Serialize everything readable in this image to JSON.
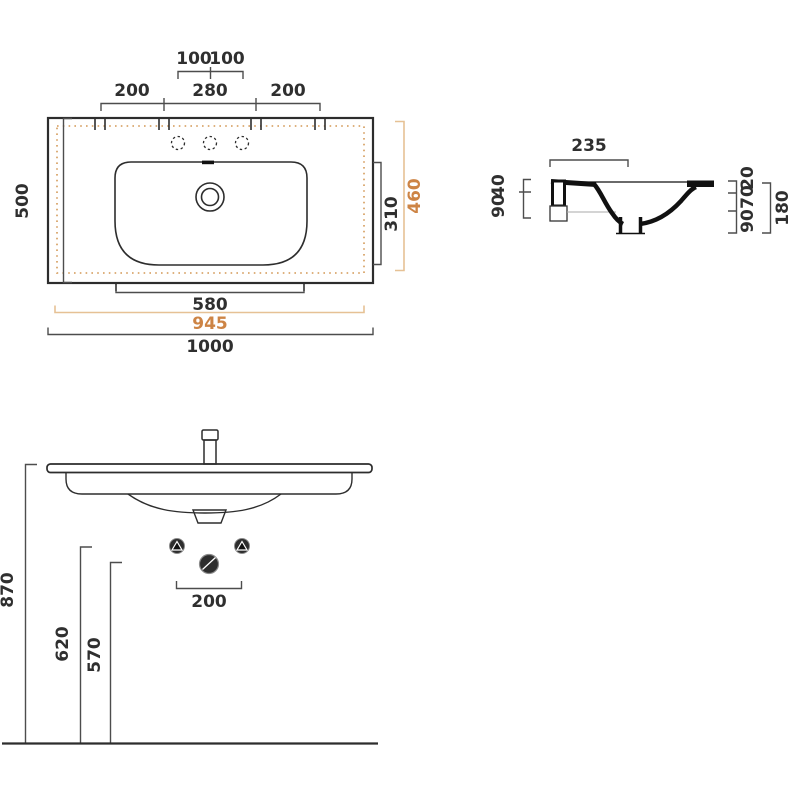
{
  "drawing_title": "washbasin-technical-drawing",
  "colors": {
    "accent": "#cd8445",
    "accent_light": "#e6c195",
    "ink": "#2d2d2d",
    "dim": "#4d4d4d"
  },
  "plan": {
    "top_small_left": "100",
    "top_small_right": "100",
    "top_left": "200",
    "top_center": "280",
    "top_right": "200",
    "left_height": "500",
    "bowl_height": "310",
    "inner_depth": "460",
    "bowl_width": "580",
    "inner_width": "945",
    "total_width": "1000"
  },
  "section": {
    "depth": "235",
    "left_top": "40",
    "left_bottom": "90",
    "right_top": "20",
    "right_mid": "70",
    "right_bottom": "90",
    "total_height": "180"
  },
  "front": {
    "height_total": "870",
    "height_fixings": "620",
    "height_drain": "570",
    "fixing_spacing": "200"
  }
}
